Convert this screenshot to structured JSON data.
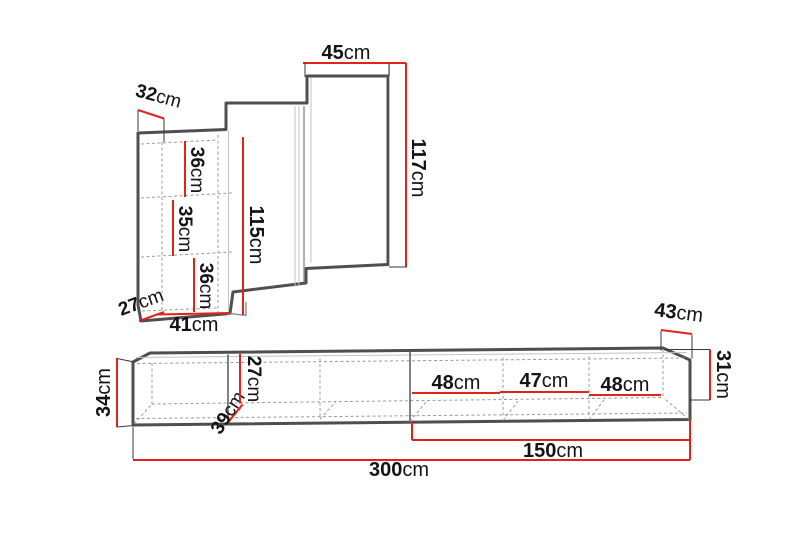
{
  "title": "Furniture set dimension diagram",
  "colors": {
    "dimension_red": "#e2231a",
    "outline_gray": "#4f4f4f",
    "hidden_line_gray": "#9b9b9b",
    "label_black": "#141414",
    "background": "#ffffff"
  },
  "wall_unit": {
    "top_depth": {
      "value": "32",
      "unit": "cm"
    },
    "top_width": {
      "value": "45",
      "unit": "cm"
    },
    "right_height": {
      "value": "117",
      "unit": "cm"
    },
    "left_height": {
      "value": "115",
      "unit": "cm"
    },
    "shelf_top": {
      "value": "36",
      "unit": "cm"
    },
    "shelf_middle": {
      "value": "35",
      "unit": "cm"
    },
    "shelf_bottom": {
      "value": "36",
      "unit": "cm"
    },
    "bottom_depth": {
      "value": "27",
      "unit": "cm"
    },
    "bottom_width": {
      "value": "41",
      "unit": "cm"
    }
  },
  "tv_bench": {
    "left_height": {
      "value": "34",
      "unit": "cm"
    },
    "left_diagonal_depth": {
      "value": "39",
      "unit": "cm"
    },
    "inner_height": {
      "value": "27",
      "unit": "cm"
    },
    "compartment_1_width": {
      "value": "48",
      "unit": "cm"
    },
    "compartment_2_width": {
      "value": "47",
      "unit": "cm"
    },
    "compartment_3_width": {
      "value": "48",
      "unit": "cm"
    },
    "right_depth": {
      "value": "43",
      "unit": "cm"
    },
    "right_height": {
      "value": "31",
      "unit": "cm"
    },
    "right_section_length": {
      "value": "150",
      "unit": "cm"
    },
    "total_length": {
      "value": "300",
      "unit": "cm"
    }
  }
}
